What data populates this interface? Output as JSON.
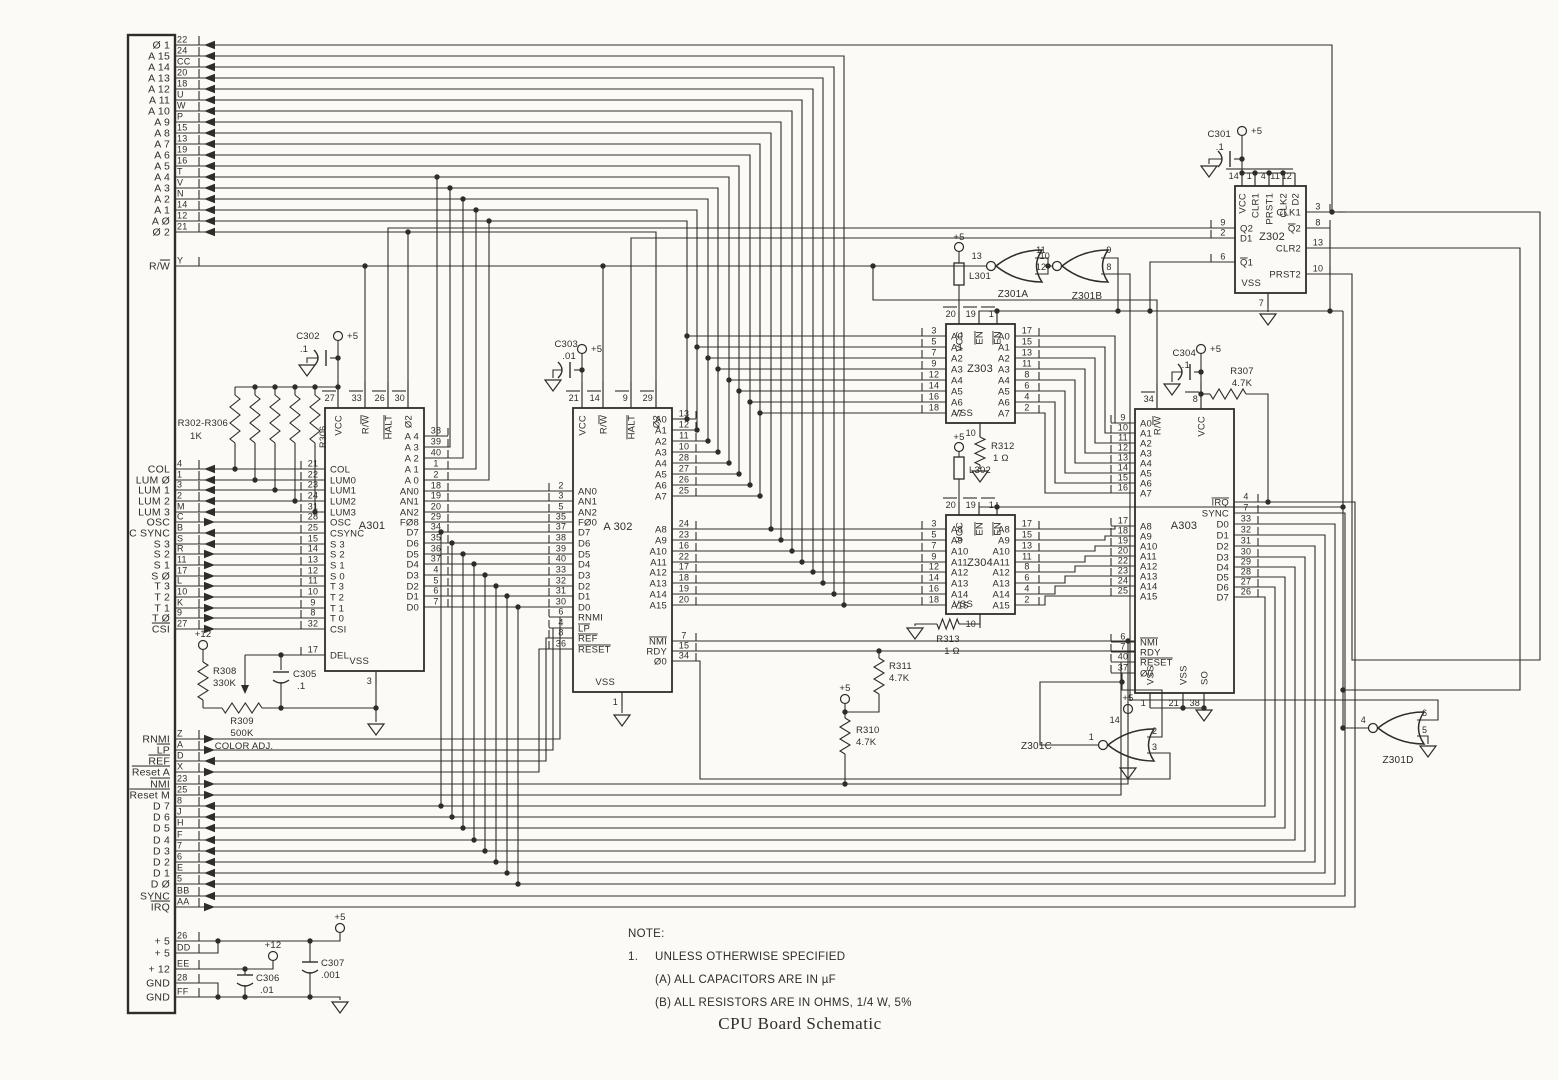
{
  "title": "CPU Board Schematic",
  "note": {
    "heading": "NOTE:",
    "item_number": "1.",
    "line1": "UNLESS OTHERWISE SPECIFIED",
    "line2": "(A) ALL CAPACITORS ARE IN µF",
    "line3": "(B) ALL RESISTORS ARE IN OHMS, 1/4 W, 5%"
  },
  "colors": {
    "paper": "#fbfaf7",
    "ink": "#2f2d2a"
  },
  "power_labels": {
    "p5": "+5",
    "p12": "+12"
  },
  "connector": {
    "groups": [
      {
        "signals": [
          {
            "name": "Ø 1",
            "pin": "22",
            "dir": "in"
          },
          {
            "name": "A 15",
            "pin": "24",
            "dir": "in"
          },
          {
            "name": "A 14",
            "pin": "CC",
            "dir": "in"
          },
          {
            "name": "A 13",
            "pin": "20",
            "dir": "in"
          },
          {
            "name": "A 12",
            "pin": "18",
            "dir": "in"
          },
          {
            "name": "A 11",
            "pin": "U",
            "dir": "in"
          },
          {
            "name": "A 10",
            "pin": "W",
            "dir": "in"
          },
          {
            "name": "A 9",
            "pin": "P",
            "dir": "in"
          },
          {
            "name": "A 8",
            "pin": "15",
            "dir": "in"
          },
          {
            "name": "A 7",
            "pin": "13",
            "dir": "in"
          },
          {
            "name": "A 6",
            "pin": "19",
            "dir": "in"
          },
          {
            "name": "A 5",
            "pin": "16",
            "dir": "in"
          },
          {
            "name": "A 4",
            "pin": "T",
            "dir": "in"
          },
          {
            "name": "A 3",
            "pin": "V",
            "dir": "in"
          },
          {
            "name": "A 2",
            "pin": "N",
            "dir": "in"
          },
          {
            "name": "A 1",
            "pin": "14",
            "dir": "in"
          },
          {
            "name": "A Ø",
            "pin": "12",
            "dir": "in"
          },
          {
            "name": "Ø 2",
            "pin": "21",
            "dir": "in"
          }
        ]
      },
      {
        "signals": [
          {
            "name": "R/~W~",
            "pin": "Y",
            "dir": "none"
          }
        ]
      },
      {
        "signals": [
          {
            "name": "COL",
            "pin": "4",
            "dir": "in"
          },
          {
            "name": "LUM Ø",
            "pin": "1",
            "dir": "in"
          },
          {
            "name": "LUM 1",
            "pin": "3",
            "dir": "in"
          },
          {
            "name": "LUM 2",
            "pin": "2",
            "dir": "in"
          },
          {
            "name": "LUM 3",
            "pin": "M",
            "dir": "in"
          },
          {
            "name": "OSC",
            "pin": "C",
            "dir": "out"
          },
          {
            "name": "C SYNC",
            "pin": "B",
            "dir": "in"
          },
          {
            "name": "S 3",
            "pin": "S",
            "dir": "in"
          },
          {
            "name": "S 2",
            "pin": "R",
            "dir": "out"
          },
          {
            "name": "S 1",
            "pin": "11",
            "dir": "out"
          },
          {
            "name": "S Ø",
            "pin": "17",
            "dir": "out"
          },
          {
            "name": "T 3",
            "pin": "L",
            "dir": "out"
          },
          {
            "name": "T 2",
            "pin": "10",
            "dir": "out"
          },
          {
            "name": "T 1",
            "pin": "K",
            "dir": "out"
          },
          {
            "name": "T Ø",
            "pin": "9",
            "dir": "out"
          },
          {
            "name": "~CSI~",
            "pin": "27",
            "dir": "out"
          }
        ]
      },
      {
        "signals": [
          {
            "name": "RNMI",
            "pin": "Z",
            "dir": "out"
          },
          {
            "name": "~LP~",
            "pin": "A",
            "dir": "out"
          },
          {
            "name": "~REF~",
            "pin": "D",
            "dir": "in"
          },
          {
            "name": "~Reset A~",
            "pin": "X",
            "dir": "out"
          },
          {
            "name": "~NMI~",
            "pin": "23",
            "dir": "out"
          },
          {
            "name": "~Reset M~",
            "pin": "25",
            "dir": "out"
          },
          {
            "name": "D 7",
            "pin": "8",
            "dir": "in"
          },
          {
            "name": "D 6",
            "pin": "J",
            "dir": "in"
          },
          {
            "name": "D 5",
            "pin": "H",
            "dir": "in"
          },
          {
            "name": "D 4",
            "pin": "F",
            "dir": "in"
          },
          {
            "name": "D 3",
            "pin": "7",
            "dir": "in"
          },
          {
            "name": "D 2",
            "pin": "6",
            "dir": "in"
          },
          {
            "name": "D 1",
            "pin": "E",
            "dir": "in"
          },
          {
            "name": "D Ø",
            "pin": "5",
            "dir": "in"
          },
          {
            "name": "SYNC",
            "pin": "BB",
            "dir": "in"
          },
          {
            "name": "~IRQ~",
            "pin": "AA",
            "dir": "out"
          }
        ]
      },
      {
        "signals": [
          {
            "name": "+ 5",
            "pin": "26",
            "dir": "none"
          },
          {
            "name": "+ 5",
            "pin": "DD",
            "dir": "none"
          },
          {
            "name": "+ 12",
            "pin": "EE",
            "dir": "none"
          },
          {
            "name": "GND",
            "pin": "28",
            "dir": "none"
          },
          {
            "name": "GND",
            "pin": "FF",
            "dir": "none"
          }
        ]
      }
    ]
  },
  "chips": {
    "A301": {
      "ref": "A301",
      "top": [
        {
          "n": "27",
          "l": "VCC"
        },
        {
          "n": "33",
          "l": "R/~W~"
        },
        {
          "n": "26",
          "l": "~HALT~"
        },
        {
          "n": "30",
          "l": "Ø2"
        }
      ],
      "left": [
        {
          "n": "21",
          "l": "COL"
        },
        {
          "n": "22",
          "l": "LUM0"
        },
        {
          "n": "23",
          "l": "LUM1"
        },
        {
          "n": "24",
          "l": "LUM2"
        },
        {
          "n": "31",
          "l": "LUM3"
        },
        {
          "n": "28",
          "l": "OSC"
        },
        {
          "n": "25",
          "l": "CSYNC"
        },
        {
          "n": "15",
          "l": "S 3"
        },
        {
          "n": "14",
          "l": "S 2"
        },
        {
          "n": "13",
          "l": "S 1"
        },
        {
          "n": "12",
          "l": "S 0"
        },
        {
          "n": "11",
          "l": "T 3"
        },
        {
          "n": "10",
          "l": "T 2"
        },
        {
          "n": "9",
          "l": "T 1"
        },
        {
          "n": "8",
          "l": "T 0"
        },
        {
          "n": "32",
          "l": "CSI"
        },
        {
          "n": "17",
          "l": "DEL"
        }
      ],
      "right": [
        {
          "n": "38",
          "l": "A 4"
        },
        {
          "n": "39",
          "l": "A 3"
        },
        {
          "n": "40",
          "l": "A 2"
        },
        {
          "n": "1",
          "l": "A 1"
        },
        {
          "n": "2",
          "l": "A 0"
        },
        {
          "n": "18",
          "l": "AN0"
        },
        {
          "n": "19",
          "l": "AN1"
        },
        {
          "n": "20",
          "l": "AN2"
        },
        {
          "n": "29",
          "l": "FØ8"
        },
        {
          "n": "34",
          "l": "D7"
        },
        {
          "n": "35",
          "l": "D6"
        },
        {
          "n": "36",
          "l": "D5"
        },
        {
          "n": "37",
          "l": "D4"
        },
        {
          "n": "4",
          "l": "D3"
        },
        {
          "n": "5",
          "l": "D2"
        },
        {
          "n": "6",
          "l": "D1"
        },
        {
          "n": "7",
          "l": "D0"
        }
      ],
      "bottom": [
        {
          "n": "3",
          "l": "VSS"
        }
      ]
    },
    "A302": {
      "ref": "A 302",
      "top": [
        {
          "n": "21",
          "l": "VCC"
        },
        {
          "n": "14",
          "l": "R/~W~"
        },
        {
          "n": "9",
          "l": "~HALT~"
        },
        {
          "n": "29",
          "l": "Ø2"
        }
      ],
      "left": [
        {
          "n": "2",
          "l": "AN0"
        },
        {
          "n": "3",
          "l": "AN1"
        },
        {
          "n": "5",
          "l": "AN2"
        },
        {
          "n": "35",
          "l": "FØ0"
        },
        {
          "n": "37",
          "l": "D7"
        },
        {
          "n": "38",
          "l": "D6"
        },
        {
          "n": "39",
          "l": "D5"
        },
        {
          "n": "40",
          "l": "D4"
        },
        {
          "n": "33",
          "l": "D3"
        },
        {
          "n": "32",
          "l": "D2"
        },
        {
          "n": "31",
          "l": "D1"
        },
        {
          "n": "30",
          "l": "D0"
        },
        {
          "n": "6",
          "l": "RNMI"
        },
        {
          "n": "4",
          "l": "~LP~"
        },
        {
          "n": "8",
          "l": "~REF~"
        },
        {
          "n": "36",
          "l": "~RESET~"
        }
      ],
      "right": [
        {
          "n": "13",
          "l": "A0"
        },
        {
          "n": "12",
          "l": "A1"
        },
        {
          "n": "11",
          "l": "A2"
        },
        {
          "n": "10",
          "l": "A3"
        },
        {
          "n": "28",
          "l": "A4"
        },
        {
          "n": "27",
          "l": "A5"
        },
        {
          "n": "26",
          "l": "A6"
        },
        {
          "n": "25",
          "l": "A7"
        },
        {
          "n": "24",
          "l": "A8"
        },
        {
          "n": "23",
          "l": "A9"
        },
        {
          "n": "16",
          "l": "A10"
        },
        {
          "n": "22",
          "l": "A11"
        },
        {
          "n": "17",
          "l": "A12"
        },
        {
          "n": "18",
          "l": "A13"
        },
        {
          "n": "19",
          "l": "A14"
        },
        {
          "n": "20",
          "l": "A15"
        },
        {
          "n": "7",
          "l": "~NMI~"
        },
        {
          "n": "15",
          "l": "RDY"
        },
        {
          "n": "34",
          "l": "Ø0"
        }
      ],
      "bottom": [
        {
          "n": "1",
          "l": "VSS"
        }
      ]
    },
    "A303": {
      "ref": "A303",
      "top": [
        {
          "n": "34",
          "l": "R/~W~"
        },
        {
          "n": "8",
          "l": "VCC"
        }
      ],
      "left": [
        {
          "n": "9",
          "l": "A0"
        },
        {
          "n": "10",
          "l": "A1"
        },
        {
          "n": "11",
          "l": "A2"
        },
        {
          "n": "12",
          "l": "A3"
        },
        {
          "n": "13",
          "l": "A4"
        },
        {
          "n": "14",
          "l": "A5"
        },
        {
          "n": "15",
          "l": "A6"
        },
        {
          "n": "16",
          "l": "A7"
        },
        {
          "n": "17",
          "l": "A8"
        },
        {
          "n": "18",
          "l": "A9"
        },
        {
          "n": "19",
          "l": "A10"
        },
        {
          "n": "20",
          "l": "A11"
        },
        {
          "n": "22",
          "l": "A12"
        },
        {
          "n": "23",
          "l": "A13"
        },
        {
          "n": "24",
          "l": "A14"
        },
        {
          "n": "25",
          "l": "A15"
        },
        {
          "n": "6",
          "l": "~NMI~"
        },
        {
          "n": "7",
          "l": "RDY"
        },
        {
          "n": "40",
          "l": "~RESET~"
        },
        {
          "n": "37",
          "l": "Ø0"
        }
      ],
      "right": [
        {
          "n": "4",
          "l": "~IRQ~"
        },
        {
          "n": "7",
          "l": "SYNC"
        },
        {
          "n": "33",
          "l": "D0"
        },
        {
          "n": "32",
          "l": "D1"
        },
        {
          "n": "31",
          "l": "D2"
        },
        {
          "n": "30",
          "l": "D3"
        },
        {
          "n": "29",
          "l": "D4"
        },
        {
          "n": "28",
          "l": "D5"
        },
        {
          "n": "27",
          "l": "D6"
        },
        {
          "n": "26",
          "l": "D7"
        }
      ],
      "bottom": [
        {
          "n": "1",
          "l": "VSS"
        },
        {
          "n": "21",
          "l": "VSS"
        },
        {
          "n": "38",
          "l": "SO"
        }
      ]
    },
    "Z302": {
      "ref": "Z302",
      "top": [
        {
          "n": "14",
          "l": "VCC"
        },
        {
          "n": "1",
          "l": "CLR1"
        },
        {
          "n": "4",
          "l": "PRST1"
        },
        {
          "n": "11",
          "l": "CLK2"
        },
        {
          "n": "12",
          "l": "D2"
        }
      ],
      "left": [
        {
          "n": "9",
          "l": "Q2"
        },
        {
          "n": "2",
          "l": "D1"
        },
        {
          "n": "6",
          "l": "~Q~1"
        }
      ],
      "right": [
        {
          "n": "3",
          "l": "CLK1"
        },
        {
          "n": "8",
          "l": "~Q~2"
        },
        {
          "n": "13",
          "l": "CLR2"
        },
        {
          "n": "10",
          "l": "PRST2"
        }
      ],
      "bottom": [
        {
          "n": "7",
          "l": "VSS"
        }
      ]
    },
    "Z303": {
      "ref": "Z303",
      "top": [
        {
          "n": "20",
          "l": "VCC"
        },
        {
          "n": "19",
          "l": "~EN~"
        },
        {
          "n": "1",
          "l": "~EN~"
        }
      ],
      "left": [
        {
          "n": "3",
          "l": "A0"
        },
        {
          "n": "5",
          "l": "A1"
        },
        {
          "n": "7",
          "l": "A2"
        },
        {
          "n": "9",
          "l": "A3"
        },
        {
          "n": "12",
          "l": "A4"
        },
        {
          "n": "14",
          "l": "A5"
        },
        {
          "n": "16",
          "l": "A6"
        },
        {
          "n": "18",
          "l": "A7"
        }
      ],
      "right": [
        {
          "n": "17",
          "l": "A0"
        },
        {
          "n": "15",
          "l": "A1"
        },
        {
          "n": "13",
          "l": "A2"
        },
        {
          "n": "11",
          "l": "A3"
        },
        {
          "n": "8",
          "l": "A4"
        },
        {
          "n": "6",
          "l": "A5"
        },
        {
          "n": "4",
          "l": "A6"
        },
        {
          "n": "2",
          "l": "A7"
        }
      ],
      "bottom": [
        {
          "n": "10",
          "l": "VSS"
        }
      ]
    },
    "Z304": {
      "ref": "Z304",
      "top": [
        {
          "n": "20",
          "l": "VCC"
        },
        {
          "n": "19",
          "l": "~EN~"
        },
        {
          "n": "1",
          "l": "~EN~"
        }
      ],
      "left": [
        {
          "n": "3",
          "l": "A8"
        },
        {
          "n": "5",
          "l": "A9"
        },
        {
          "n": "7",
          "l": "A10"
        },
        {
          "n": "9",
          "l": "A11"
        },
        {
          "n": "12",
          "l": "A12"
        },
        {
          "n": "14",
          "l": "A13"
        },
        {
          "n": "16",
          "l": "A14"
        },
        {
          "n": "18",
          "l": "A15"
        }
      ],
      "right": [
        {
          "n": "17",
          "l": "A8"
        },
        {
          "n": "15",
          "l": "A9"
        },
        {
          "n": "13",
          "l": "A10"
        },
        {
          "n": "11",
          "l": "A11"
        },
        {
          "n": "8",
          "l": "A12"
        },
        {
          "n": "6",
          "l": "A13"
        },
        {
          "n": "4",
          "l": "A14"
        },
        {
          "n": "2",
          "l": "A15"
        }
      ],
      "bottom": [
        {
          "n": "10",
          "l": "VSS"
        }
      ]
    }
  },
  "gates": [
    {
      "ref": "Z301A",
      "out": "13",
      "in1": "11",
      "in2": "12"
    },
    {
      "ref": "Z301B",
      "out": "10",
      "in1": "9",
      "in2": "8"
    },
    {
      "ref": "Z301C",
      "out": "1",
      "in1": "2",
      "in2": "3",
      "vcc": "14"
    },
    {
      "ref": "Z301D",
      "out": "4",
      "in1": "6",
      "in2": "5"
    }
  ],
  "components": {
    "resistors": [
      {
        "ref": "R302-R306",
        "value": "1K"
      },
      {
        "ref": "R307",
        "value": "4.7K"
      },
      {
        "ref": "R308",
        "value": "330K"
      },
      {
        "ref": "R309",
        "value": "500K",
        "note": "COLOR ADJ."
      },
      {
        "ref": "R310",
        "value": "4.7K"
      },
      {
        "ref": "R311",
        "value": "4.7K"
      },
      {
        "ref": "R312",
        "value": "1 Ω"
      },
      {
        "ref": "R313",
        "value": "1 Ω"
      },
      {
        "ref": "R306",
        "value": ""
      }
    ],
    "capacitors": [
      {
        "ref": "C301",
        "value": ".1"
      },
      {
        "ref": "C302",
        "value": ".1"
      },
      {
        "ref": "C303",
        "value": ".01"
      },
      {
        "ref": "C304",
        "value": ".1"
      },
      {
        "ref": "C305",
        "value": ".1"
      },
      {
        "ref": "C306",
        "value": ".01"
      },
      {
        "ref": "C307",
        "value": ".001"
      }
    ],
    "inductors": [
      {
        "ref": "L301"
      },
      {
        "ref": "L302"
      }
    ]
  }
}
